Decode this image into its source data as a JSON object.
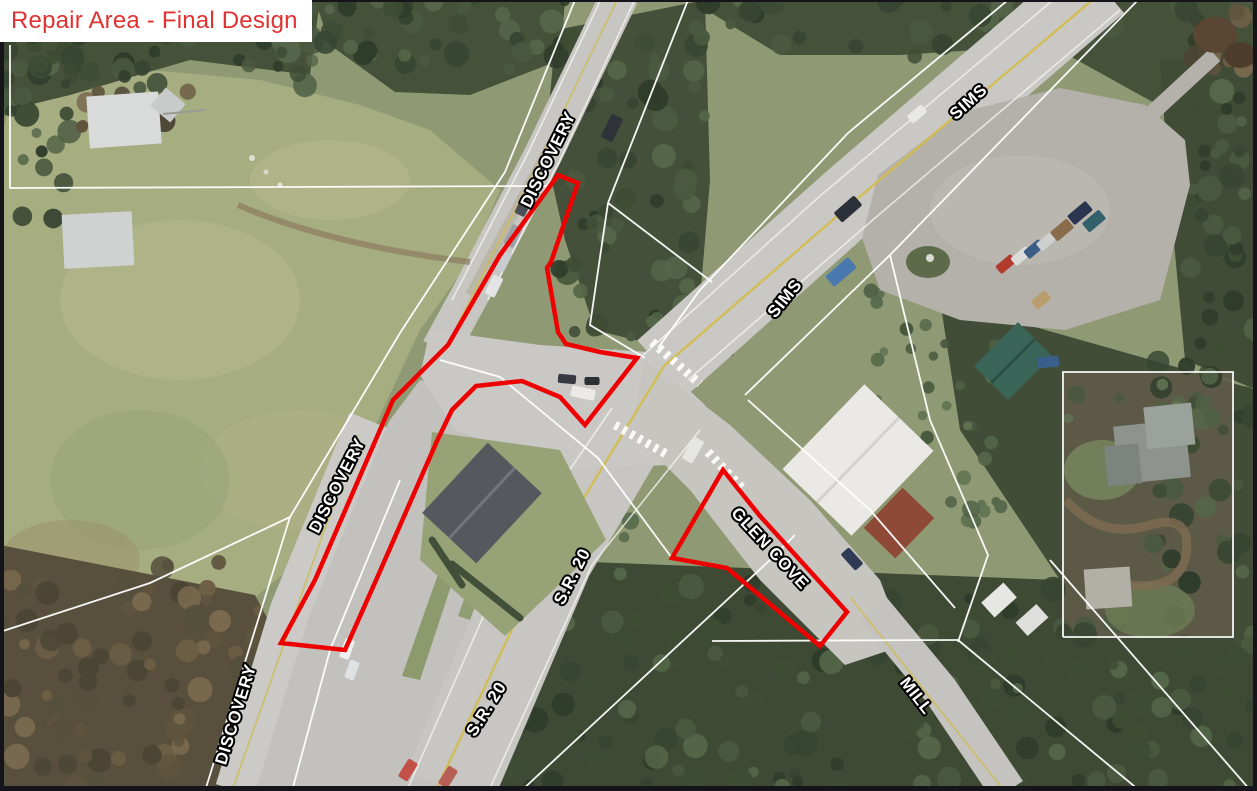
{
  "title": {
    "text": "Repair Area - Final Design",
    "color": "#e03230",
    "background": "#ffffff"
  },
  "map": {
    "road_labels": [
      {
        "id": "discovery-top",
        "label": "DISCOVERY",
        "x": 553,
        "y": 162,
        "rot": -64
      },
      {
        "id": "discovery-mid",
        "label": "DISCOVERY",
        "x": 342,
        "y": 488,
        "rot": -63
      },
      {
        "id": "discovery-bottom",
        "label": "DISCOVERY",
        "x": 241,
        "y": 716,
        "rot": -73
      },
      {
        "id": "sims-top",
        "label": "SIMS",
        "x": 972,
        "y": 106,
        "rot": -42
      },
      {
        "id": "sims-mid",
        "label": "SIMS",
        "x": 789,
        "y": 302,
        "rot": -51
      },
      {
        "id": "sr20-mid",
        "label": "S.R. 20",
        "x": 577,
        "y": 579,
        "rot": -63
      },
      {
        "id": "sr20-bottom",
        "label": "S.R. 20",
        "x": 491,
        "y": 712,
        "rot": -58
      },
      {
        "id": "glen-cove",
        "label": "GLEN COVE",
        "x": 766,
        "y": 552,
        "rot": 47
      },
      {
        "id": "mill",
        "label": "MILL",
        "x": 912,
        "y": 699,
        "rot": 52
      }
    ],
    "repair_areas": {
      "outline_color": "#ee0000",
      "polygons": [
        {
          "name": "discovery-road-corridor",
          "points": "578,183 551,262 547,268 558,332 566,344 600,352 637,358 585,425 560,397 522,381 476,386 452,410 437,441 377,578 345,650 281,643 315,580 393,400 448,345 500,255 558,175"
        },
        {
          "name": "glen-cove-approach",
          "points": "723,470 760,516 847,612 820,646 727,568 672,558"
        }
      ]
    },
    "line_colors": {
      "parcel": "#ffffff",
      "centerline": "#d2bd4f"
    }
  }
}
